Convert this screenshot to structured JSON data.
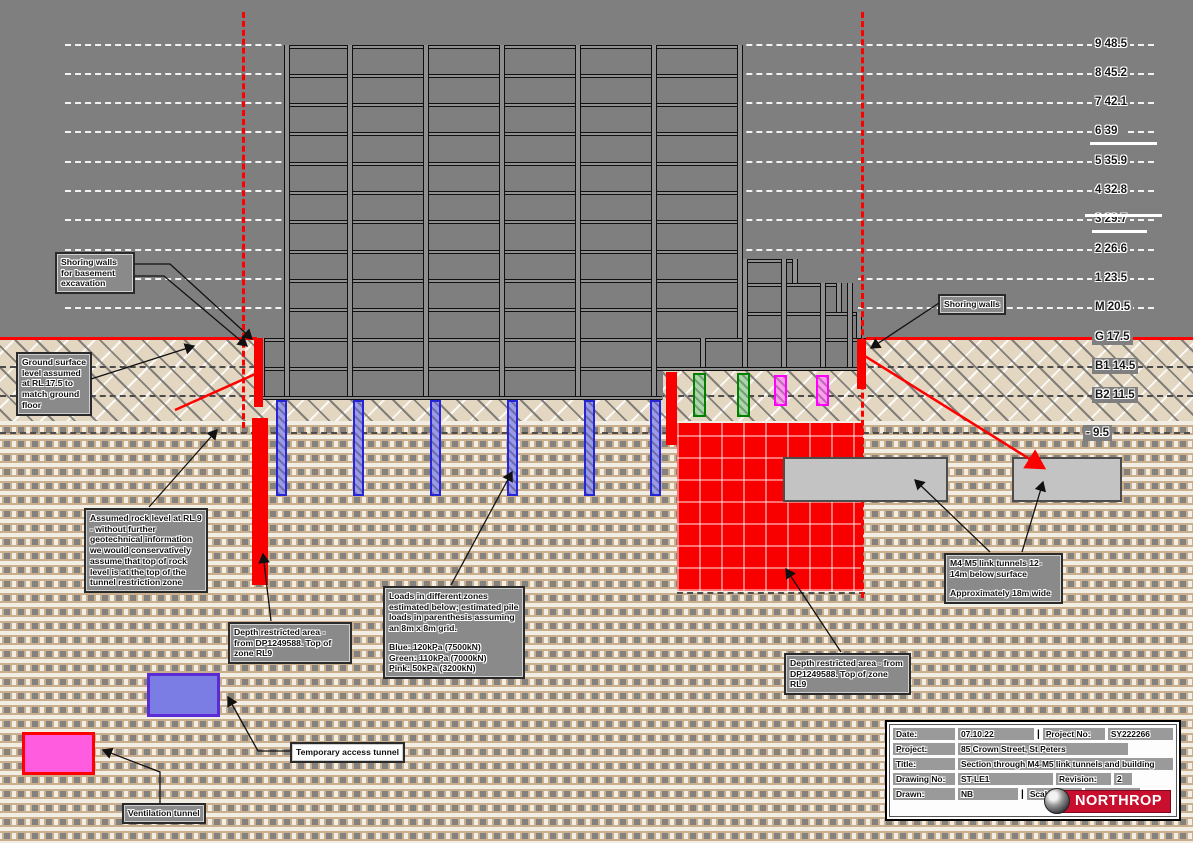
{
  "drawing": {
    "levels": [
      "9 48.5",
      "8 45.2",
      "7 42.1",
      "6 39",
      "5 35.9",
      "4 32.8",
      "3 29.7",
      "2 26.6",
      "1 23.5",
      "M 20.5",
      "G 17.5",
      "B1 14.5",
      "B2 11.5"
    ],
    "rock_level_label": "- 9.5",
    "annotations": {
      "shoring_basement": "Shoring walls for basement excavation",
      "ground_surface": "Ground surface level assumed at RL 17.5 to match ground floor",
      "assumed_rock": "Assumed rock level at RL 9 - without further geotechnical information we would conservatively assume that top of rock level is at the top of the tunnel restriction zone",
      "depth_restricted_left": "Depth restricted area - from DP1249588. Top of zone RL9",
      "loads_intro": "Loads in different zones estimated below; estimated pile loads in parenthesis assuming an 8m x 8m grid.",
      "loads_blue": "Blue: 120kPa (7500kN)",
      "loads_green": "Green: 110kPa (7000kN)",
      "loads_pink": "Pink: 50kPa (3200kN)",
      "temporary_access": "Temporary access tunnel",
      "ventilation": "Ventilation tunnel",
      "depth_restricted_right": "Depth restricted area - from DP1249588. Top of zone RL9",
      "m4m5_line1": "M4-M5 link tunnels 12-14m below surface",
      "m4m5_line2": "Approximately 18m wide",
      "shoring_walls": "Shoring walls"
    },
    "title_block": {
      "date_label": "Date:",
      "date": "07.10.22",
      "project_no_label": "Project No:",
      "project_no": "SY222266",
      "project_label": "Project:",
      "project": "85 Crown Street, St Peters",
      "title_label": "Title:",
      "title": "Section through M4-M5 link tunnels and building",
      "drawing_no_label": "Drawing No:",
      "drawing_no": "ST-LE1",
      "revision_label": "Revision:",
      "revision": "2",
      "drawn_label": "Drawn:",
      "drawn": "NB",
      "scale_label": "Scale:",
      "scale": "1:500",
      "logo": "NORTHROP"
    },
    "colors": {
      "restricted_zone": "#f80000",
      "shoring_wall": "#f80000",
      "ground_line": "#ff0000",
      "pile_blue_border": "#2424d8",
      "pile_blue_fill": "#9a9ae8",
      "pile_green_border": "#008000",
      "pile_green_fill": "#a8d8a8",
      "pile_pink_border": "#ff00ff",
      "pile_pink_fill": "#ff9bf0",
      "tunnel_gray": "#c3c3c3",
      "access_tunnel_fill": "#7b7ce4",
      "access_tunnel_border": "#5b2bd6",
      "vent_tunnel_fill": "#ff5ce0",
      "vent_tunnel_border": "#ff0000",
      "logo_red": "#c8102e"
    }
  }
}
